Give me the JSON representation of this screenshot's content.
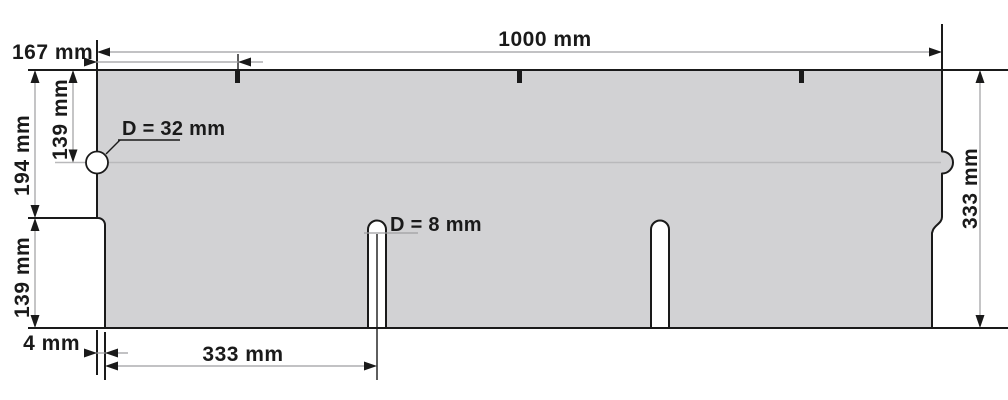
{
  "drawing": {
    "type": "technical-dimension-drawing",
    "subject": "shingle panel with edge notch, edge tab and two bottom slots",
    "labels": {
      "width_total": "1000 mm",
      "top_offset": "167 mm",
      "upper_height": "194 mm",
      "notch_center_height": "139 mm",
      "lower_height": "139 mm",
      "edge_inset": "4 mm",
      "slot_spacing": "333 mm",
      "total_height": "333 mm",
      "notch_diameter": "D = 32 mm",
      "slot_diameter": "D = 8 mm"
    },
    "colors": {
      "background": "#ffffff",
      "panel_fill": "#d2d2d4",
      "outline": "#1a1a1a",
      "dimension_line": "#9e9ea0",
      "centerline": "#b9b9bb",
      "text": "#1a1a1a"
    }
  }
}
